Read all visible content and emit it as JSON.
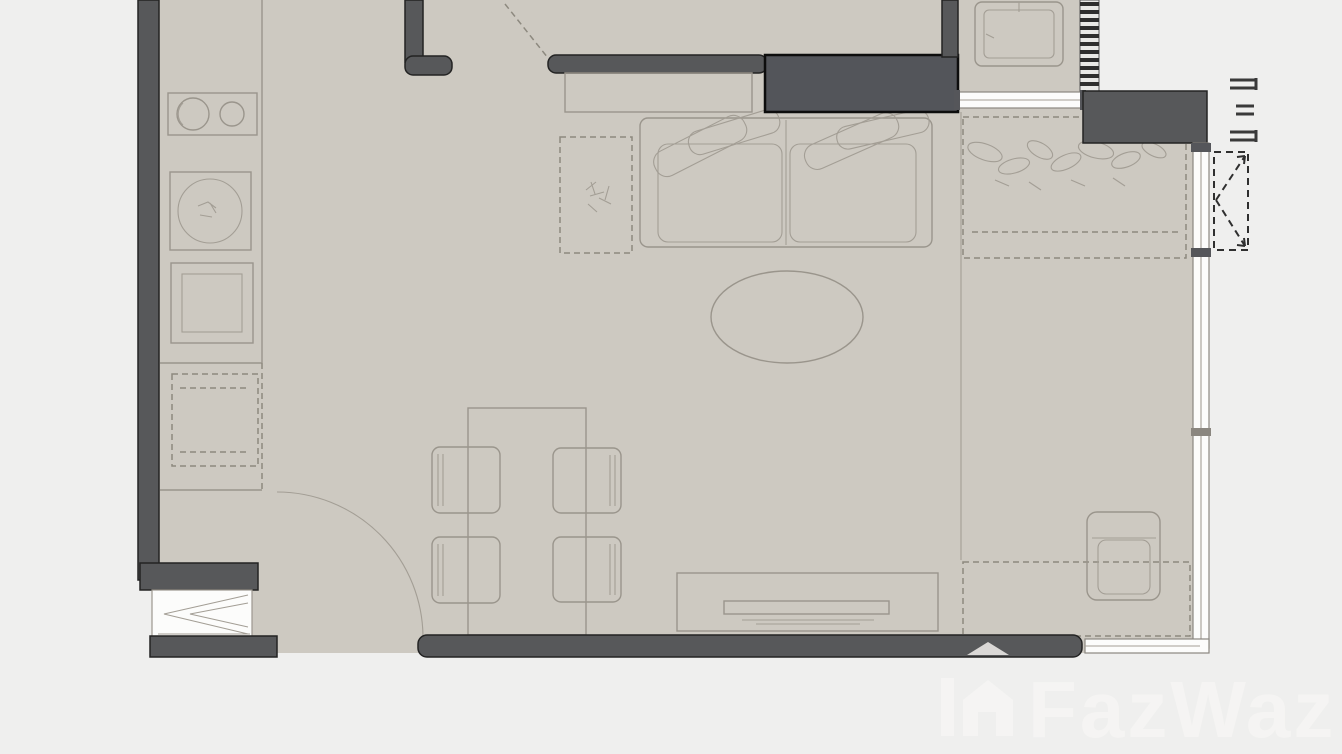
{
  "document": {
    "type": "apartment floor plan drawing",
    "rooms_visible": [
      "kitchen",
      "living-dining area",
      "bedroom area",
      "balcony-window band",
      "entry"
    ],
    "labels_visible_in_pixels": []
  },
  "watermark": {
    "brand": "FazWaz",
    "style": "light translucent logo with house glyph, bottom-right"
  },
  "symbols": [
    "kitchen-counter",
    "stove-two-burners",
    "kitchen-sink",
    "washing-machine",
    "refrigerator-dashed",
    "entry-door-swing-arc",
    "entry-chevron-door",
    "dining-table",
    "dining-chair",
    "sofa-two-seat",
    "sofa-pillows",
    "side-table-plant",
    "oval-coffee-table",
    "tv-console",
    "tv-screen",
    "bed-dashed-outline",
    "bed-pillow-scribbles",
    "desk-dashed",
    "desk-chair",
    "wardrobe-solid-dark",
    "bathroom-cabinet",
    "louver-hatch-strip",
    "window-band-right",
    "window-band-top",
    "window-band-bottom",
    "casement-opening-dashed-arrows",
    "section-marks-dashed"
  ],
  "colors": {
    "floor": "#cdc9c1",
    "floor_bed": "#d6d2ca",
    "outside": "#efefee",
    "wall": "#57585a",
    "wall_border": "#232323",
    "wardrobe_fill": "#53555a",
    "furniture_line": "#9a958c",
    "dashed_line": "#8d897f",
    "window_fill": "#fcfcfb",
    "watermark": "#f7f6f4"
  }
}
